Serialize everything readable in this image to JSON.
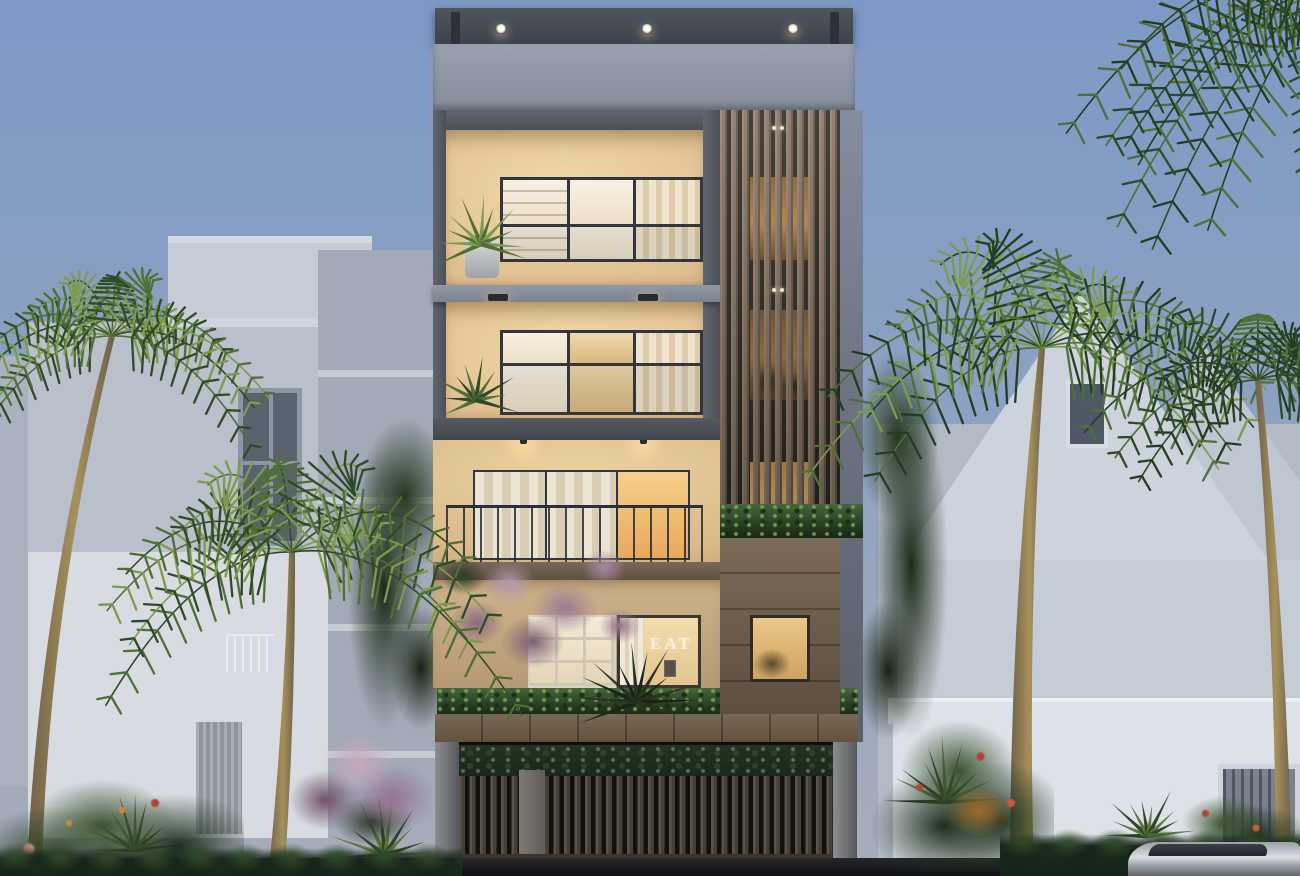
{
  "scene": {
    "setting": "Dusk exterior rendering of a modern five-storey residence with warm-lit interiors, a timber slat screen, planted balconies, a gated carport with parked cars, tropical palms and ghosted neighbouring villas",
    "signage": {
      "eat": "EAT"
    },
    "counts": {
      "roof_downlights": 3,
      "carport_cars": 3,
      "palm_trees": 4,
      "upper_levels": 4
    }
  },
  "colors": {
    "sky_top": "#7c99c6",
    "sky_mid": "#90a3c0",
    "sky_bottom": "#a8adb9",
    "roof_slab_hi": "#50555e",
    "roof_slab_lo": "#3d424b",
    "roof_bracket": "#2e3238",
    "parapet_hi": "#9aa1ae",
    "parapet_lo": "#858c9a",
    "frame_hi": "#62676f",
    "frame_lo": "#4b5058",
    "right_col_hi": "#878da0",
    "right_col_lo": "#5a5f6a",
    "wall_hi": "#f2d8a8",
    "wall_mid": "#e0c092",
    "wall_lo": "#cdab7e",
    "wall_d_hi": "#cfb28a",
    "wall_d_lo": "#b79a74",
    "mullion": "#33363b",
    "pane_white": "#f6f1e4",
    "pane_cream": "#ecdfc8",
    "curtain_a": "#efe5cf",
    "curtain_b": "#ddcbaa",
    "warm_room": "#eed9ae",
    "warm_glow": "#f7cf8d",
    "warm_glow_deep": "#e8a95c",
    "slat_wood": "#8d7a69",
    "slat_wood_dark": "#6d5c4d",
    "slat_base_hi": "#3a372f",
    "slat_base_lo": "#2c2925",
    "open_hi": "#edbd74",
    "open_mid": "#c08d4e",
    "open_lo": "#6e5233",
    "planter_hi": "#46653a",
    "planter_lo": "#182616",
    "wood_wall_hi": "#7b6a58",
    "wood_wall_lo": "#5d4e40",
    "wood_band_hi": "#7a6856",
    "wood_band_lo": "#63523f",
    "slab_ab_hi": "#9298a4",
    "slab_ab_lo": "#7c828e",
    "band_dark_hi": "#555a63",
    "band_dark_lo": "#41454d",
    "wood_slab_hi": "#79695a",
    "wood_slab_lo": "#5f5040",
    "railing": "#2c2f34",
    "pillar_hi": "#8b8c8e",
    "pillar_lo": "#55565a",
    "carport_hi": "#2a2620",
    "carport_lo": "#17150f",
    "fence_slat": "#5a534b",
    "fence_slat_dark": "#463f38",
    "fence_gap": "#12100d",
    "fence_post": "#7d7a75",
    "gate_glow": "#e69637",
    "car_hi": "#26262a",
    "car_lo": "#0e0e10",
    "taillight": "#d84438",
    "plate": "#cfc8b8",
    "ghost_wall": "#b9c0cb",
    "ghost_block": "#c5ccd6",
    "ghost_tower": "#a2aab7",
    "ghost_white": "#d8dce2",
    "ghost_window": "#59626f",
    "ghost_body": "#dde1e8",
    "ghost_gable": "#ccd3dd",
    "ghost_gable2": "#bec6d2",
    "ghost_side": "#b2bac6",
    "ghost_door": "#7b828d",
    "trunk": "#6d6149",
    "trunk_lit": "#a6905c",
    "frond_deep": "#243d22",
    "frond_dark": "#2e4a28",
    "frond_mid": "#4e6f38",
    "frond_light": "#7d9a4e",
    "bush_dark": "#1d2f1d",
    "bush_mid": "#2f4527",
    "bush_light": "#3a5330",
    "bush_warm": "#c98a3e",
    "flower_red": "#b04532",
    "flower_pink": "#b598ae",
    "flower_pink_deep": "#8a6a82",
    "hedge_hi": "#2f4929",
    "hedge_lo": "#16241a",
    "road_hi": "#26262a",
    "road_lo": "#101114",
    "silver_hi": "#d9dde1",
    "silver_lo": "#62676d",
    "fan_lit": "#5d7a3c",
    "tree_sil_a": "#1b2418",
    "tree_sil_b": "#283420",
    "eat_text": "#f7f1e2"
  }
}
